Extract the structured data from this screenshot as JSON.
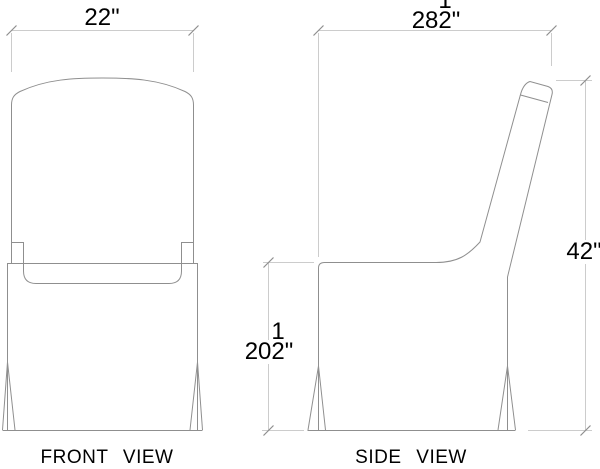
{
  "views": {
    "front": {
      "label": "FRONT VIEW"
    },
    "side": {
      "label": "SIDE VIEW"
    }
  },
  "dimensions": {
    "back_width": {
      "whole": "22",
      "unit": "\""
    },
    "overall_depth": {
      "whole": "28",
      "fraction_num": "1",
      "fraction_den": "2",
      "unit": "\""
    },
    "overall_height": {
      "whole": "42",
      "unit": "\""
    },
    "seat_height": {
      "whole": "20",
      "fraction_num": "1",
      "fraction_den": "2",
      "unit": "\""
    }
  },
  "colors": {
    "background": "#ffffff",
    "object_line": "#8f8f8f",
    "dimension_line": "#cccccc",
    "tick": "#8f8f8f",
    "text": "#000000",
    "label_underline": "#d8d8d8"
  }
}
